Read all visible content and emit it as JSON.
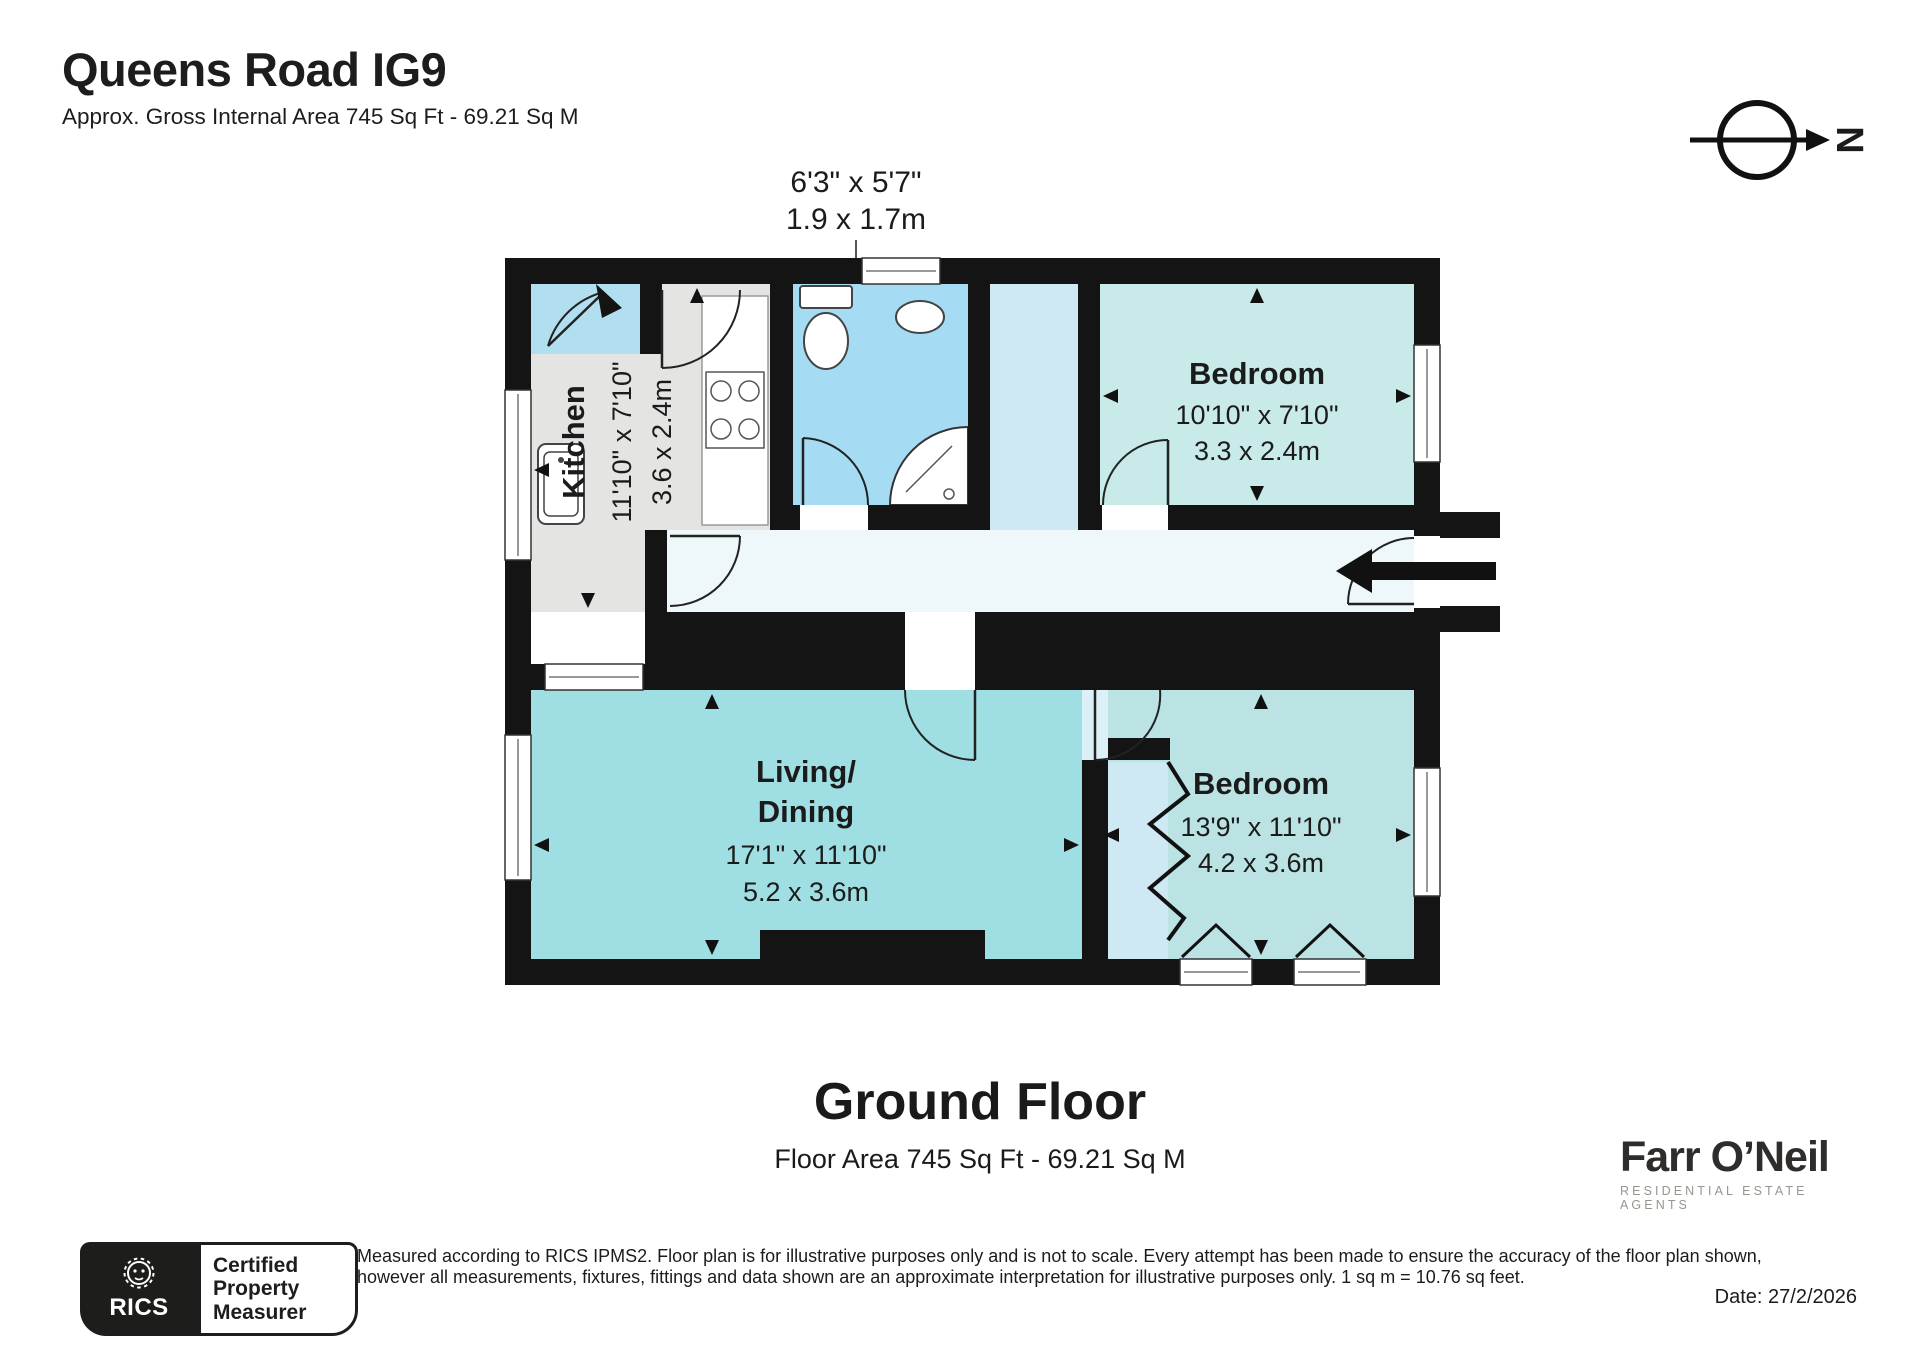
{
  "header": {
    "title": "Queens Road IG9",
    "subtitle": "Approx. Gross Internal Area 745 Sq Ft - 69.21 Sq M"
  },
  "compass": {
    "north_label": "N"
  },
  "floorplan": {
    "callout": {
      "imperial": "6'3\" x 5'7\"",
      "metric": "1.9 x 1.7m"
    },
    "rooms": {
      "kitchen": {
        "name": "Kitchen",
        "imperial": "11'10\" x 7'10\"",
        "metric": "3.6 x 2.4m"
      },
      "bedroom_top": {
        "name": "Bedroom",
        "imperial": "10'10\" x 7'10\"",
        "metric": "3.3 x 2.4m"
      },
      "living_dining": {
        "name_line1": "Living/",
        "name_line2": "Dining",
        "imperial": "17'1\" x 11'10\"",
        "metric": "5.2 x 3.6m"
      },
      "bedroom_bottom": {
        "name": "Bedroom",
        "imperial": "13'9\" x 11'10\"",
        "metric": "4.2 x 3.6m"
      }
    },
    "palette": {
      "wall": "#141414",
      "kitchen_floor": "#e4e4e3",
      "bathroom_floor": "#a6dcf3",
      "bedroom_top_floor": "#c8eae9",
      "bedroom_bottom_floor": "#bce3e3",
      "living_floor": "#9fdfe3",
      "hallway_floor": "#eef8fb"
    }
  },
  "floor_summary": {
    "title": "Ground Floor",
    "subtitle": "Floor Area 745 Sq Ft - 69.21 Sq M"
  },
  "footer": {
    "rics_badge": {
      "brand": "RICS",
      "caption_line1": "Certified",
      "caption_line2": "Property",
      "caption_line3": "Measurer"
    },
    "disclaimer_line1": "Measured according to RICS IPMS2. Floor plan is for illustrative purposes only and is not to scale. Every attempt has been made to ensure the accuracy of the floor plan shown,",
    "disclaimer_line2": "however all measurements, fixtures, fittings and data shown are an approximate interpretation for illustrative purposes only. 1 sq m = 10.76 sq feet.",
    "date": "Date: 27/2/2026",
    "agency": {
      "name": "Farr O’Neil",
      "tagline": "RESIDENTIAL ESTATE AGENTS"
    }
  }
}
